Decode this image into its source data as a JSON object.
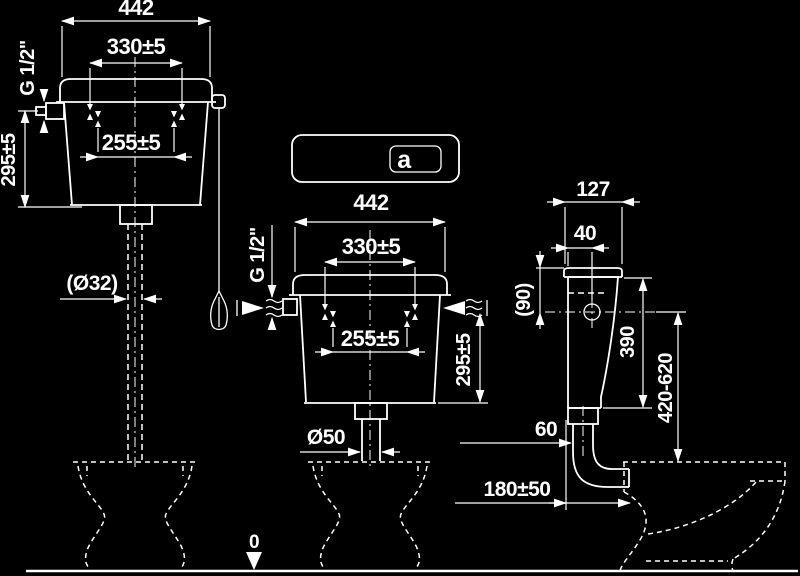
{
  "colors": {
    "background": "#000000",
    "line": "#ffffff"
  },
  "high_cistern_view": {
    "overall_width": "442",
    "upper_hole_spacing": "330±5",
    "lower_hole_spacing": "255±5",
    "inlet_thread": "G 1/2\"",
    "inlet_to_bottom_height": "295±5",
    "flush_pipe_diameter": "(Ø32)"
  },
  "lid_front_view": {
    "logo_glyph": "a"
  },
  "low_cistern_view": {
    "overall_width": "442",
    "upper_hole_spacing": "330±5",
    "lower_hole_spacing": "255±5",
    "inlet_thread": "G 1/2\"",
    "inlet_to_bottom_height": "295±5",
    "outlet_diameter": "Ø50"
  },
  "side_view": {
    "depth": "127",
    "inlet_offset_from_back": "40",
    "inlet_below_top": "(90)",
    "tank_height": "390",
    "flush_pipe_length_range": "420-620",
    "outlet_offset": "60",
    "tank_to_bowl_distance": "180±50"
  },
  "floor_datum": {
    "level": "0"
  }
}
